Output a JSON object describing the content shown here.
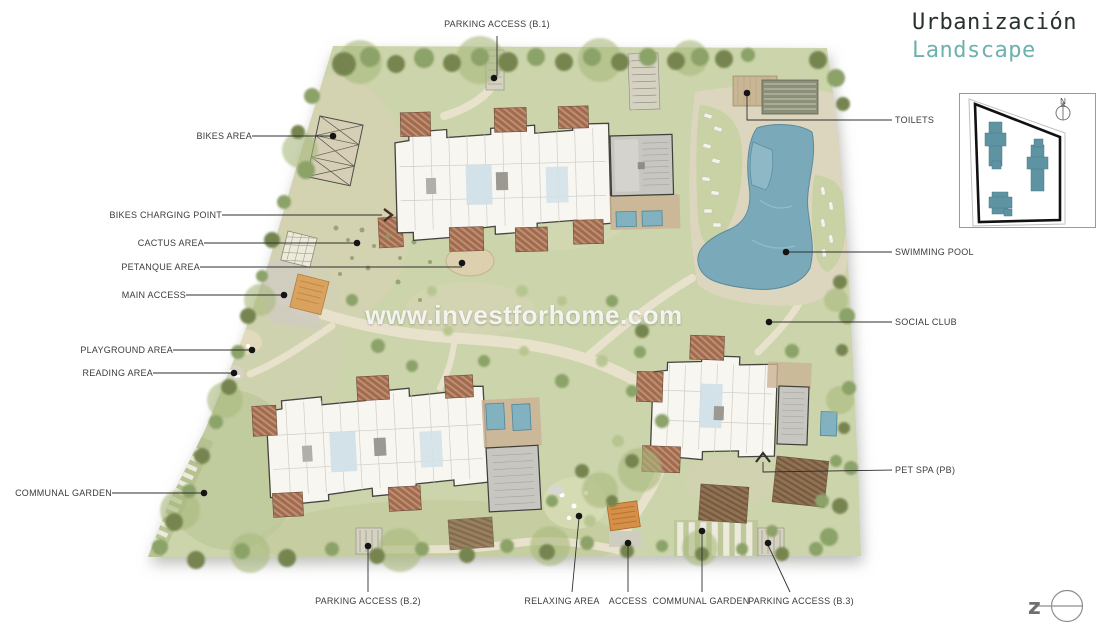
{
  "title": {
    "line1": "Urbanización",
    "line2": "Landscape"
  },
  "watermark": "www.investforhome.com",
  "compass": {
    "north_label": "N"
  },
  "logo": {
    "letter": "z"
  },
  "labels": {
    "top": [
      {
        "text": "PARKING ACCESS (B.1)"
      }
    ],
    "left": [
      {
        "text": "BIKES AREA"
      },
      {
        "text": "BIKES CHARGING POINT"
      },
      {
        "text": "CACTUS AREA"
      },
      {
        "text": "PETANQUE AREA"
      },
      {
        "text": "MAIN ACCESS"
      },
      {
        "text": "PLAYGROUND AREA"
      },
      {
        "text": "READING AREA"
      },
      {
        "text": "COMMUNAL GARDEN"
      }
    ],
    "right": [
      {
        "text": "TOILETS"
      },
      {
        "text": "SWIMMING POOL"
      },
      {
        "text": "SOCIAL CLUB"
      },
      {
        "text": "PET SPA (PB)"
      }
    ],
    "bottom": [
      {
        "text": "PARKING ACCESS (B.2)"
      },
      {
        "text": "RELAXING AREA"
      },
      {
        "text": "ACCESS"
      },
      {
        "text": "COMMUNAL GARDEN"
      },
      {
        "text": "PARKING ACCESS (B.3)"
      }
    ]
  },
  "icons": {
    "north_compass": "compass-north-arrow",
    "bikes_charging_arrow": "chevron-right",
    "pet_spa_arrow": "chevron-up",
    "logo_mark": "z-circle-crosshair"
  },
  "colors": {
    "accent_teal": "#6fb1ae",
    "title_dark": "#27312f",
    "lawn_green": "#ccd4ab",
    "pool_blue": "#7aa9b9",
    "terrace_brown": "#a06b50",
    "minimap_building": "#5e93a2",
    "label_text": "#3c3c3c"
  }
}
